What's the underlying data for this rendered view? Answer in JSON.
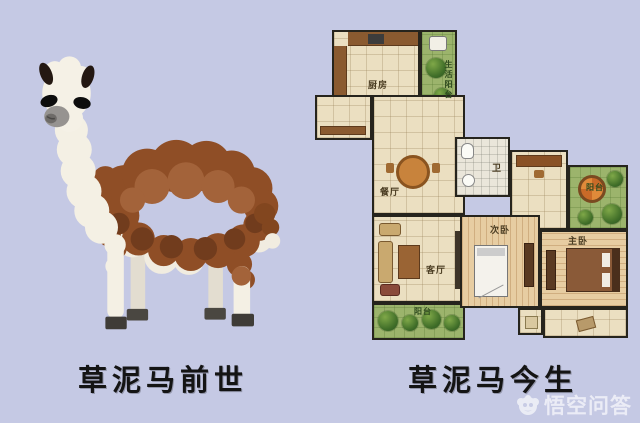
{
  "page": {
    "background_color": "#c5c9e4",
    "wall_color": "#26241d",
    "floor_color": "#ebdfc1",
    "balcony_green": "#9cb46c"
  },
  "left_panel": {
    "caption": "草泥马前世",
    "subject": "alpaca-figurine-photo"
  },
  "right_panel": {
    "caption": "草泥马今生",
    "subject": "apartment-floor-plan"
  },
  "floorplan": {
    "rooms": [
      {
        "id": "kitchen",
        "label": "厨房"
      },
      {
        "id": "utility-balcony",
        "label": "生活阳台"
      },
      {
        "id": "dining",
        "label": "餐厅"
      },
      {
        "id": "bathroom",
        "label": "卫"
      },
      {
        "id": "living-room",
        "label": "客厅"
      },
      {
        "id": "living-balcony",
        "label": "阳台"
      },
      {
        "id": "bedroom-second",
        "label": "次卧"
      },
      {
        "id": "master-bedroom",
        "label": "主卧"
      },
      {
        "id": "leisure-balcony",
        "label": "阳台"
      }
    ]
  },
  "watermark": {
    "logo": "wukong-monkey-cloud-icon",
    "text": "悟空问答",
    "text_color": "rgba(255,255,255,0.65)"
  }
}
